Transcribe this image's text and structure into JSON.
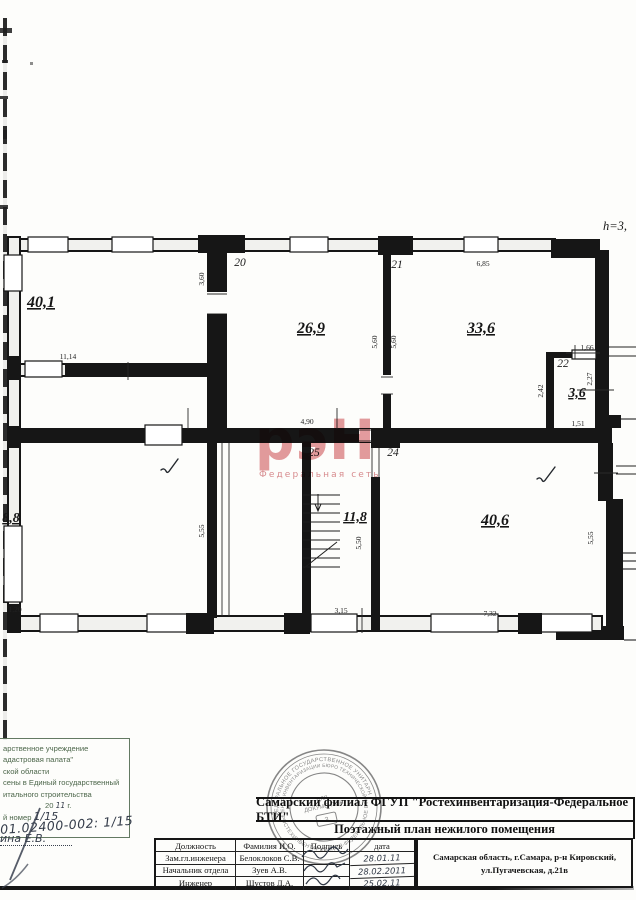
{
  "plan": {
    "ceiling_height": "h=3,",
    "areas": {
      "r40_1": "40,1",
      "r26_9": "26,9",
      "r33_6": "33,6",
      "r3_6": "3,6",
      "r8_8": "8,8",
      "r11_8": "11,8",
      "r40_6": "40,6"
    },
    "room_numbers": {
      "n20": "20",
      "n21": "21",
      "n22": "22",
      "n24": "24",
      "n25": "25"
    },
    "dims": {
      "d11_14": "11,14",
      "d3_60": "3,60",
      "d6_85": "6,85",
      "d5_60a": "5,60",
      "d5_60b": "5,60",
      "d1_66": "1,66",
      "d2_27": "2,27",
      "d2_42": "2,42",
      "d1_51": "1,51",
      "d4_90": "4,90",
      "d5_55a": "5,55",
      "d1_20": "1,20",
      "d5_50": "5,50",
      "d3_15": "3,15",
      "d7_32": "7,32",
      "d5_55b": "5,55"
    }
  },
  "watermark": {
    "logo": "рэН",
    "tagline": "Федеральная сеть"
  },
  "round_stamp": {
    "ring_top": "ФЕДЕРАЛЬНОЕ ГОСУДАРСТВЕННОЕ УНИТАРНОЕ ПРЕДПРИЯТИЕ",
    "ring_bottom": "РОСТЕХИНВЕНТАРИЗАЦИЯ-ФЕДЕРАЛЬНОЕ БТИ",
    "ring_inner": "ЦЕНТР ИНВЕНТАРИЗАЦИИ  БЮРО ТЕХНИЧЕСКОЙ",
    "center_line1": "ДЛЯ",
    "center_line2": "ДОКУМЕНТОВ",
    "number": "3"
  },
  "title_block": {
    "org": "Самарский филиал ФГУП \"Ростехинвентаризация-Федеральное БТИ\"",
    "doc_title": "Поэтажный план нежилого помещения",
    "address_line1": "Самарская область, г.Самара, р-н Кировский,",
    "address_line2": "ул.Пугачевская, д.21в"
  },
  "personnel_table": {
    "headers": [
      "Должность",
      "Фамилия И.О.",
      "Подпись",
      "дата"
    ],
    "rows": [
      {
        "position": "Зам.гл.инженера",
        "name": "Белоклоков С.В.",
        "date": "28.01.11"
      },
      {
        "position": "Начальник отдела",
        "name": "Зуев А.В.",
        "date": "28.02.2011"
      },
      {
        "position": "Инженер",
        "name": "Шустов Д.А.",
        "date": "25.02.11"
      }
    ]
  },
  "registry_stamp": {
    "line1": "арственное учреждение",
    "line2": "адастровая палата\"",
    "line3": "ской области",
    "line4": "сены в Единый государственный",
    "line5": "итального строительства",
    "year_prefix": "20",
    "year_hand": "11",
    "year_suffix": "г.",
    "number_label": "й номер",
    "number_hand": "1/15",
    "hand_number": "01.02400-002: 1/15",
    "hand_name": "ина Е.В."
  }
}
